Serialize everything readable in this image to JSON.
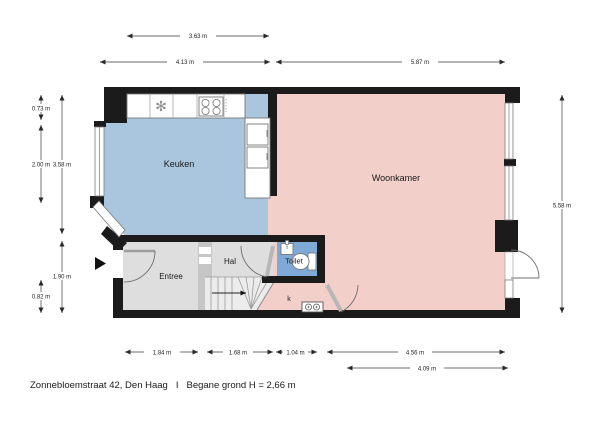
{
  "rooms": {
    "keuken": "Keuken",
    "woonkamer": "Woonkamer",
    "entree": "Entree",
    "hal": "Hal",
    "toilet": "Toilet",
    "closet": "k"
  },
  "dimensions": {
    "top": [
      "3.63 m",
      "4.13 m",
      "5.87 m"
    ],
    "left": [
      "0.73 m",
      "2.00 m",
      "3.58 m",
      "1.90 m",
      "0.82 m"
    ],
    "right": [
      "5.58 m"
    ],
    "bottom": [
      "1.84 m",
      "1.68 m",
      "1.04 m",
      "4.56 m",
      "4.09 m"
    ]
  },
  "footer": {
    "address": "Zonnebloemstraat 42, Den Haag",
    "separator": "I",
    "detail": "Begane grond H = 2,66 m"
  },
  "colors": {
    "kitchen": "#a9c6de",
    "living": "#f2cfc9",
    "hall": "#dedede",
    "hall_band": "#c6c6c6",
    "stairs": "#ececec",
    "toilet": "#7fa9d6",
    "wall": "#1b1b1b"
  },
  "icons": {
    "entrance_arrow": "entrance-direction",
    "sink": "sink-drain",
    "stove": "four-burner-hob",
    "washer": "washing-machine",
    "stairs_arrow": "stairs-up-arrow"
  }
}
